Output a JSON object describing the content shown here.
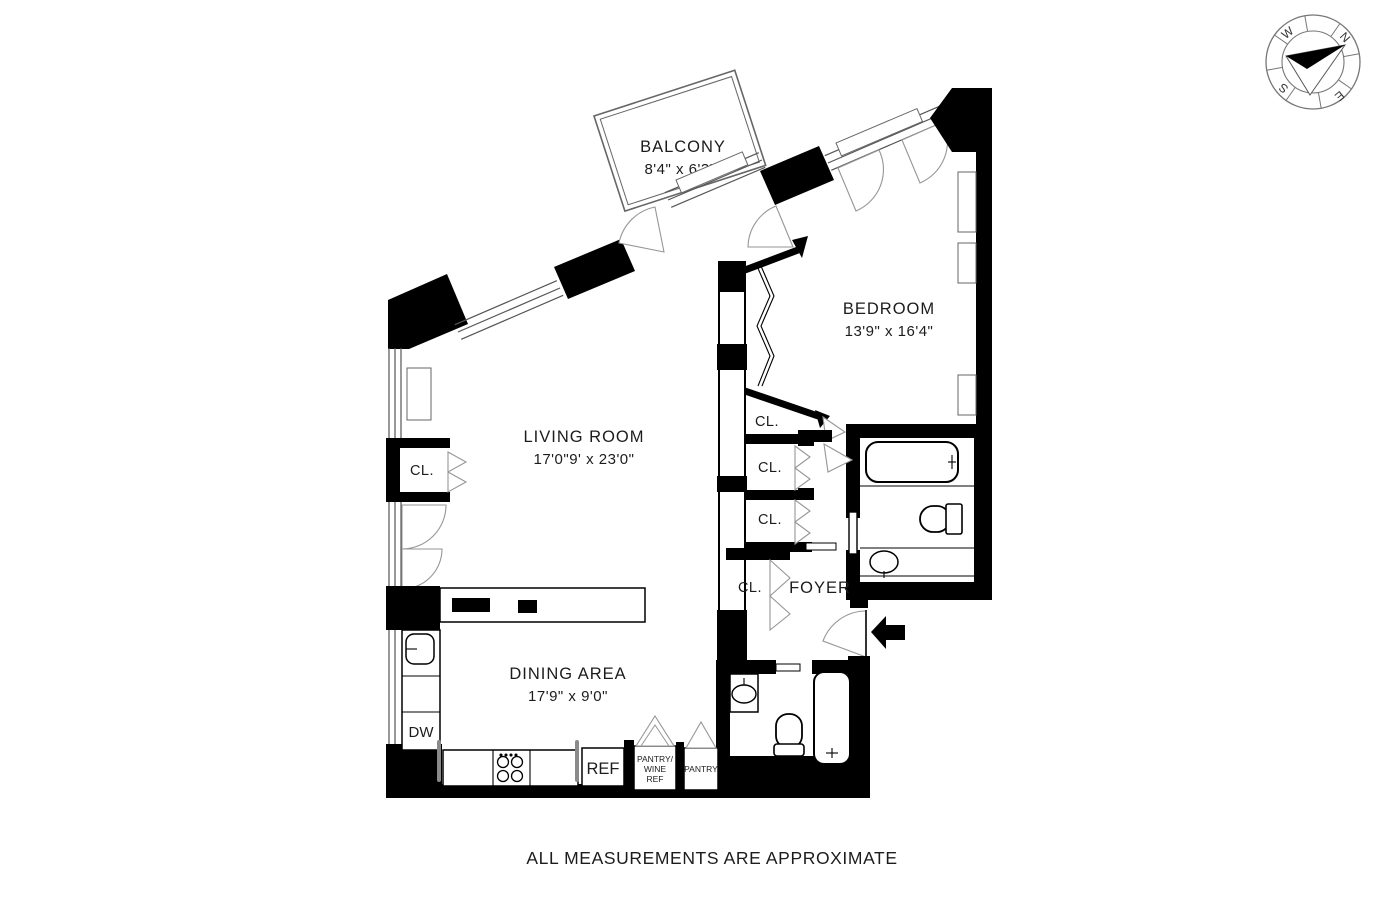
{
  "page": {
    "footer": "ALL MEASUREMENTS ARE APPROXIMATE"
  },
  "compass": {
    "north": "N",
    "south": "S",
    "east": "E",
    "west": "W"
  },
  "rooms": {
    "balcony": {
      "name": "BALCONY",
      "dims": "8'4\" x 6'3\""
    },
    "bedroom": {
      "name": "BEDROOM",
      "dims": "13'9\" x 16'4\""
    },
    "living_room": {
      "name": "LIVING ROOM",
      "dims": "17'0\"9' x 23'0\""
    },
    "dining_area": {
      "name": "DINING AREA",
      "dims": "17'9\" x 9'0\""
    },
    "foyer": {
      "name": "FOYER"
    }
  },
  "fixtures": {
    "closet": "CL.",
    "dishwasher": "DW",
    "refrigerator": "REF",
    "pantry_wine": {
      "line1": "PANTRY/",
      "line2": "WINE",
      "line3": "REF"
    },
    "pantry": "PANTRY"
  },
  "colors": {
    "wall": "#000000",
    "background": "#ffffff",
    "fixture_line": "#555555"
  }
}
